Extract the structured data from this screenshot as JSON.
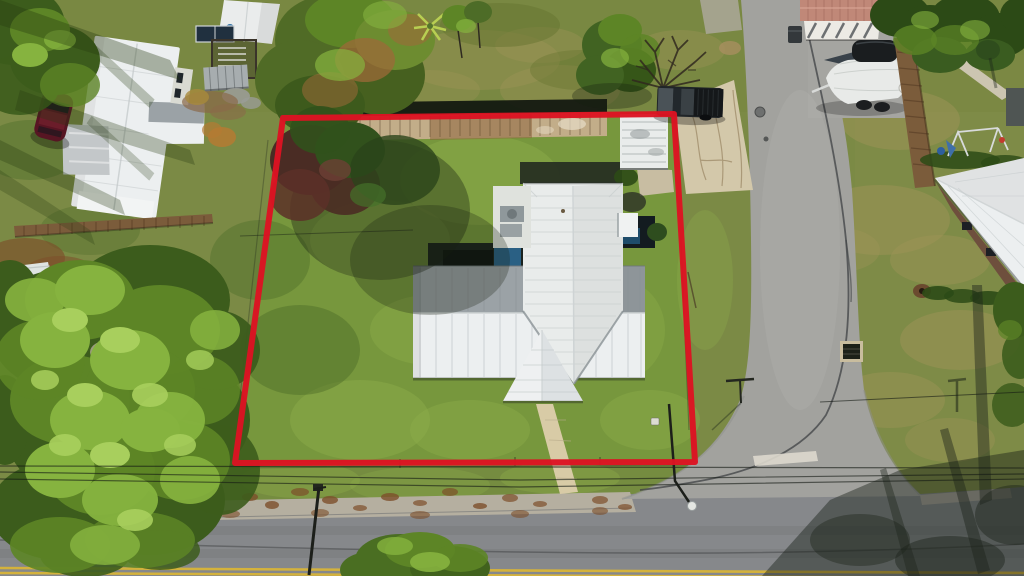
{
  "image": {
    "type": "aerial-drone-photograph",
    "description": "Overhead aerial real-estate photo of a residential lot outlined in red: a single-story home with a white metal cross-gable roof sits on a grassy parcel between a large pine tree, a two-lane asphalt road at the bottom and a concrete side street on the right, surrounded by neighboring houses, sheds, a covered boat, a pickup truck and mature trees.",
    "width_px": 1024,
    "height_px": 576
  },
  "annotation": {
    "label": "property-boundary-outline",
    "shape": "quadrilateral",
    "stroke_px": 6,
    "corners_px": [
      [
        283,
        118
      ],
      [
        674,
        114
      ],
      [
        695,
        462
      ],
      [
        235,
        463
      ]
    ]
  },
  "colors": {
    "boundary_red": "#dd1322",
    "grass_base": "#7b8a45",
    "grass_bright": "#74a236",
    "grass_light": "#8fae4b",
    "grass_shade": "#4c6b27",
    "grass_dry": "#9d9457",
    "asphalt": "#86888b",
    "concrete_road": "#a2a29e",
    "gutter": "#b5afa0",
    "line_yellow": "#d4b23c",
    "paint_white": "#ddd8cd",
    "roof_white": "#eceff0",
    "roof_gray": "#9ba2a6",
    "roof_wing": "#e9eceb",
    "ridge_light": "#ced3d4",
    "walkway_tan": "#d8cba6",
    "driveway_tan": "#d3c8aa",
    "dirt_tan": "#c2ad89",
    "wood_brown": "#7b5c3b",
    "hedge_dark": "#2c4a16",
    "canopy_mid": "#5d8526",
    "canopy_light": "#86b33f",
    "canopy_lighter": "#a8cf5d",
    "pine_dark": "#3c5c1c",
    "rust_foliage": "#9c6a38",
    "maroon_tree": "#4a2c24",
    "shadow_dark": "rgba(22,30,16,0.45)",
    "house_blue": "#2a6084",
    "dark_structure": "#1b231e",
    "truck_dark": "#202528",
    "car_maroon": "#571523",
    "boat_white": "#e8eae8",
    "cover_black": "#1a1d1f",
    "pink_roof": "#c08878",
    "white_band": "#eceae4",
    "brick_wall": "#6e4f3d",
    "metal_gray": "#a7adaf",
    "solar_blue": "#20303f",
    "play_blue": "#3f6fa8",
    "play_red": "#c23b2e",
    "debris_gray": "#a39b8a",
    "litter_brown": "#7d4f2a",
    "pole_dark": "#1c1f1a",
    "wire_dark": "#141a14"
  },
  "scene": {
    "main_house": {
      "label": "Single-story home with white metal cross-gable roof, front gable porch and rear wing"
    },
    "front_walkway": {
      "label": "Tan concrete walkway from front porch toward the road"
    },
    "storage_shed": {
      "label": "White corrugated-metal shed behind the house"
    },
    "backyard": {
      "label": "Shaded rear patio structures with dark-blue house walls and AC pad"
    },
    "front_road": {
      "label": "Two-lane asphalt road with double yellow center line"
    },
    "side_road": {
      "label": "Concrete side street meeting the front road at a T-intersection with painted stop bar and manhole"
    },
    "driveway": {
      "label": "Cracked concrete driveway from side street to rear shed"
    },
    "neighbors": {
      "left_house": {
        "label": "Neighboring house with white metal roof and carport"
      },
      "red_car": {
        "label": "Dark-red car parked beside left house"
      },
      "left_shed": {
        "label": "White gable shed, raised deck with solar panel and gray metal shed"
      },
      "pickup_truck": {
        "label": "Dark pickup truck parked at top of driveway"
      },
      "boat": {
        "label": "Trailered boat under white cover with black motor cover"
      },
      "pink_building": {
        "label": "Salmon metal-roof outbuilding at top right"
      },
      "wood_fence": {
        "label": "Brown wooden privacy fence along side street"
      },
      "playground": {
        "label": "Backyard playset with blue slide and swing frame"
      },
      "right_house": {
        "label": "House with white hip roof at far right"
      },
      "trash_bin": {
        "label": "Wheeled trash bin at curb"
      }
    },
    "vegetation": {
      "label": "Large pine canopy lower left, mixed yard trees, hedges and bare branch tree"
    },
    "utilities": {
      "label": "Overhead power lines, utility pole, street light, street sign and storm culvert"
    }
  }
}
